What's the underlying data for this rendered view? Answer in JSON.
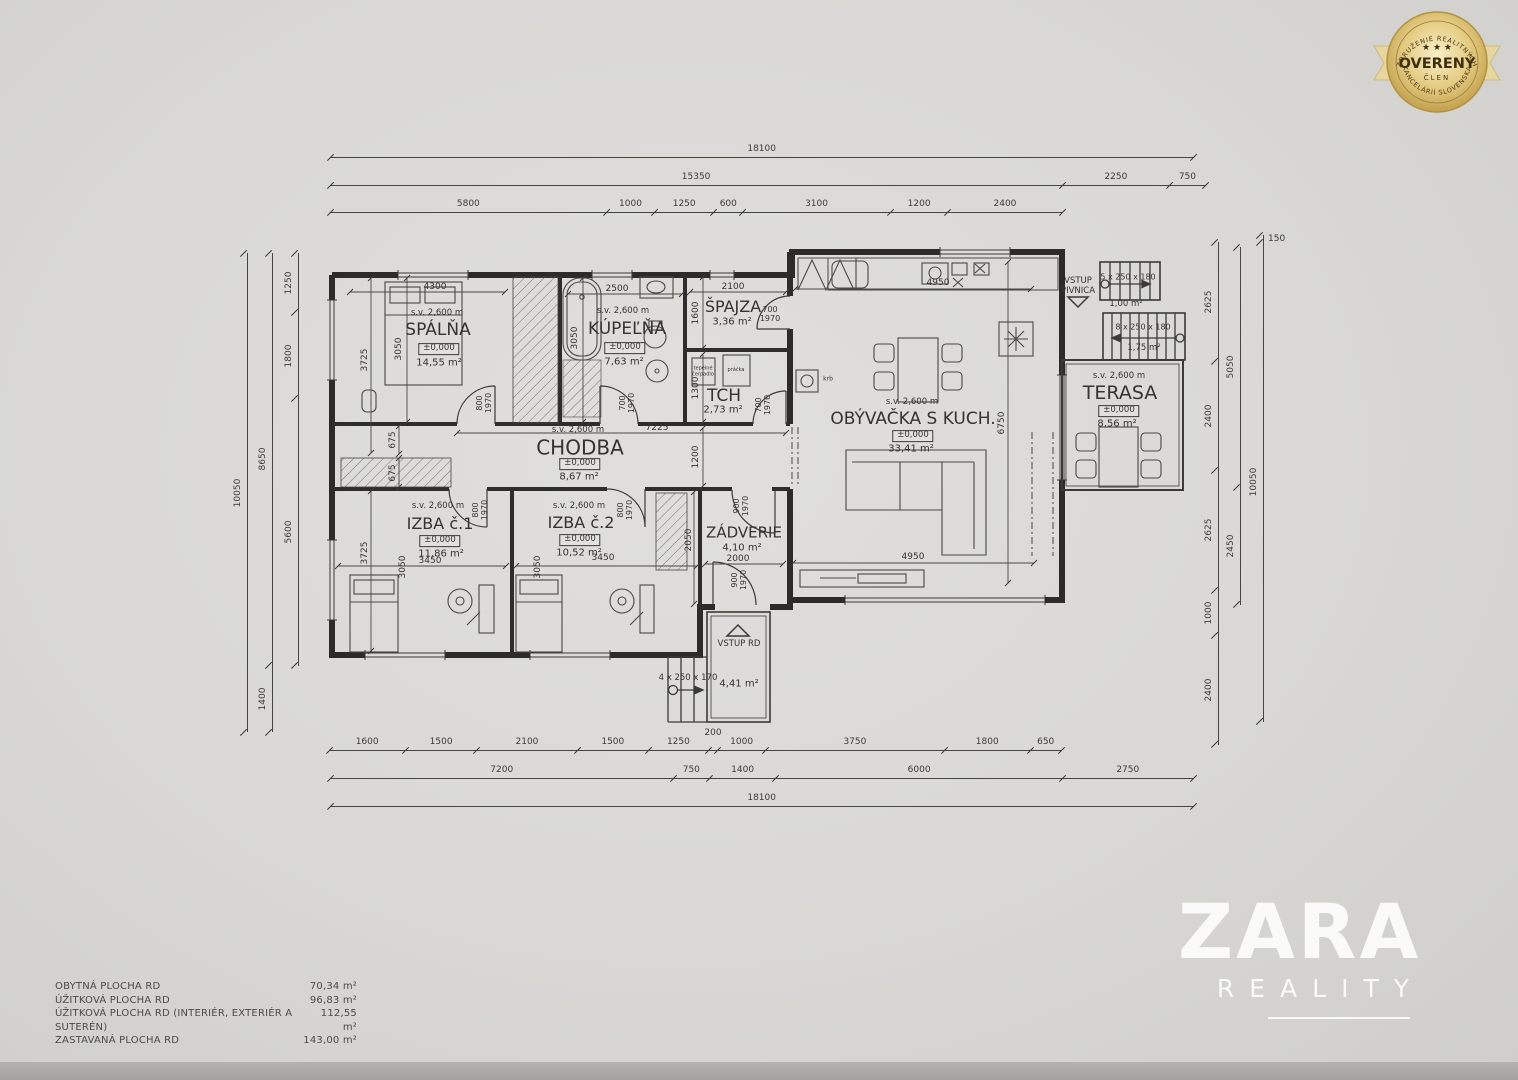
{
  "badge": {
    "arc_top": "ZDRUŽENIE REALITNÝCH",
    "stars": "★ ★ ★",
    "title": "OVERENÝ",
    "subtitle": "ČLEN",
    "arc_bottom": "KANCELÁRIÍ SLOVENSKA",
    "gold": "#c9a94e"
  },
  "logo": {
    "name": "ZARA",
    "sub": "REALITY"
  },
  "rooms": {
    "spalna": {
      "sv": "s.v. 2,600 m",
      "name": "SPÁLŇA",
      "level": "±0,000",
      "area": "14,55 m²"
    },
    "kupelna": {
      "sv": "s.v. 2,600 m",
      "name": "KÚPEĽŇA",
      "level": "±0,000",
      "area": "7,63 m²"
    },
    "spajza": {
      "name": "ŠPAJZA",
      "area": "3,36 m²"
    },
    "tch": {
      "name": "TCH",
      "area": "2,73 m²"
    },
    "chodba": {
      "sv": "s.v. 2,600 m",
      "name": "CHODBA",
      "level": "±0,000",
      "area": "8,67 m²"
    },
    "izba1": {
      "sv": "s.v. 2,600 m",
      "name": "IZBA č.1",
      "level": "±0,000",
      "area": "11,86 m²"
    },
    "izba2": {
      "sv": "s.v. 2,600 m",
      "name": "IZBA č.2",
      "level": "±0,000",
      "area": "10,52 m²"
    },
    "zadverie": {
      "name": "ZÁDVERIE",
      "area": "4,10 m²"
    },
    "obyvacka": {
      "sv": "s.v. 2,600 m",
      "name": "OBÝVAČKA S KUCH.",
      "level": "±0,000",
      "area": "33,41 m²"
    },
    "terasa": {
      "sv": "s.v. 2,600 m",
      "name": "TERASA",
      "level": "±0,000",
      "area": "8,56 m²"
    }
  },
  "stairs": {
    "pivnica_label": "VSTUP\nPIVNICA",
    "upper": "5 x 250 x 180",
    "upper_area": "1,00 m²",
    "lower": "8 x 250 x 180",
    "lower_area": "1,75 m²",
    "entry": "4 x 250 x 170",
    "entry_area": "4,41 m²",
    "vstup_rd": "VSTUP RD"
  },
  "dims": {
    "top1": [
      "18100"
    ],
    "top2": [
      "15350",
      "2250",
      "750"
    ],
    "top3": [
      "5800",
      "1000",
      "1250",
      "600",
      "3100",
      "1200",
      "2400"
    ],
    "bot1": [
      "1600",
      "1500",
      "2100",
      "1500",
      "1250",
      "200",
      "1000",
      "3750",
      "1800",
      "650"
    ],
    "bot2": [
      "7200",
      "750",
      "1400",
      "6000",
      "2750"
    ],
    "bot3": [
      "18100"
    ],
    "left_inner": [
      "1250",
      "1800",
      "5600"
    ],
    "left_mid": [
      "8650",
      "1400"
    ],
    "left_outer": [
      "10050"
    ],
    "right_inner": [
      "2625",
      "2400",
      "2625",
      "1000",
      "2400"
    ],
    "right_mid": [
      "5050",
      "2450"
    ],
    "right_outer": [
      "150",
      "10050"
    ],
    "inner": {
      "spalna_w": "4300",
      "spalna_h": "3050",
      "spalna_left": "3725",
      "spalna_left2": "675",
      "kupelna_w": "2500",
      "kupelna_h": "3050",
      "spajza_w": "2100",
      "spajza_h": "1600",
      "tch_h": "1300",
      "chodba_w": "7225",
      "chodba_h": "1200",
      "izba1_w": "3450",
      "izba1_h": "3050",
      "izba1_left": "3725",
      "izba1_left2": "675",
      "izba2_w": "3450",
      "izba2_h": "3050",
      "zadverie_h": "2050",
      "zadverie_w": "2000",
      "kitchen_w": "4950",
      "obyvacka_h": "6750",
      "obyvacka_w": "4950",
      "door_spalna": "800\n1970",
      "door_kupelna": "700\n1970",
      "door_spajza": "700\n1970",
      "door_tch": "700\n1970",
      "door_izba1": "800\n1970",
      "door_izba2": "800\n1970",
      "door_zadverie_top": "900\n1970",
      "door_zadverie_bot": "900\n1970"
    },
    "tch_left_box": "tepelné\nčerpadlo",
    "tch_right_box": "práčka",
    "krb": "krb"
  },
  "legend": {
    "rows": [
      {
        "label": "OBYTNÁ PLOCHA RD",
        "value": "70,34 m²"
      },
      {
        "label": "ÚŽITKOVÁ PLOCHA RD",
        "value": "96,83 m²"
      },
      {
        "label": "ÚŽITKOVÁ PLOCHA RD (INTERIÉR, EXTERIÉR A SUTERÉN)",
        "value": "112,55 m²"
      },
      {
        "label": "ZASTAVANÁ PLOCHA RD",
        "value": "143,00 m²"
      }
    ]
  }
}
